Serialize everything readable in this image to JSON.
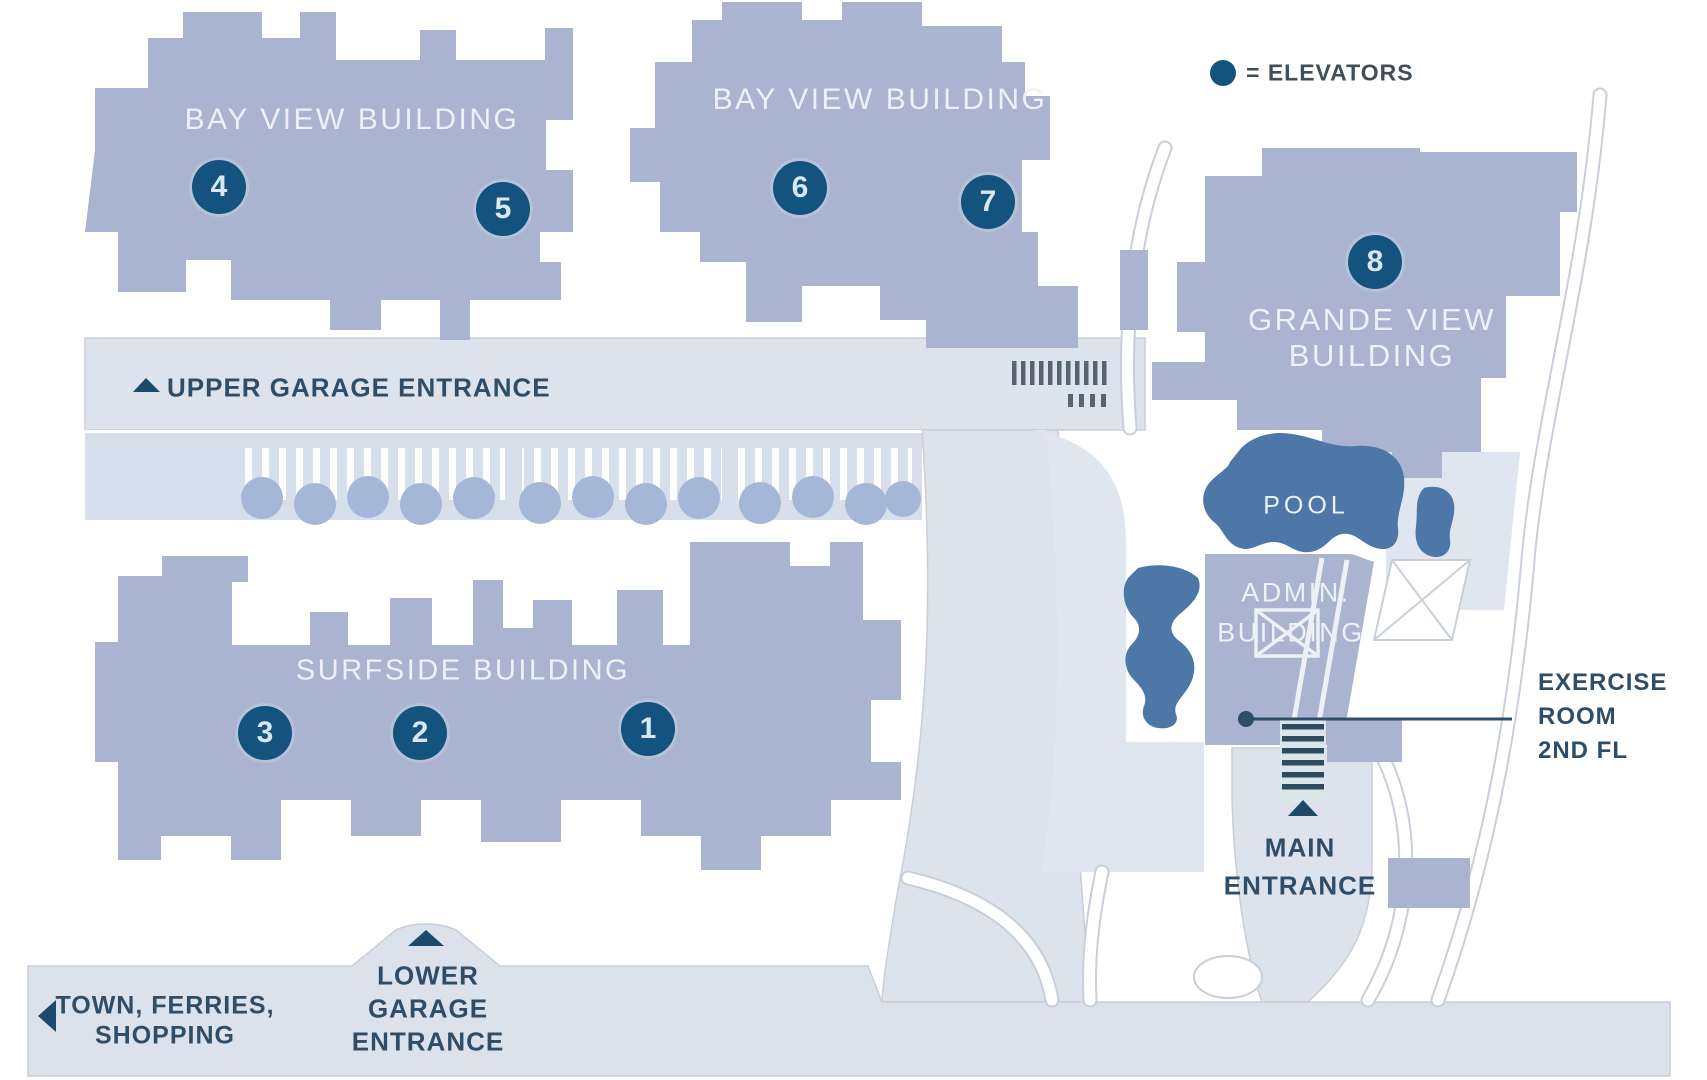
{
  "map": {
    "legend": {
      "symbol": "elevator-dot",
      "label": "= ELEVATORS"
    },
    "buildings": {
      "bay_view_west": {
        "label": "BAY VIEW BUILDING"
      },
      "bay_view_east": {
        "label": "BAY VIEW BUILDING"
      },
      "grande_view": {
        "label_line1": "GRANDE VIEW",
        "label_line2": "BUILDING"
      },
      "surfside": {
        "label": "SURFSIDE BUILDING"
      },
      "admin": {
        "label_line1": "ADMIN.",
        "label_line2": "BUILDING"
      },
      "pool": {
        "label": "POOL"
      }
    },
    "elevator_markers": [
      {
        "number": "4"
      },
      {
        "number": "5"
      },
      {
        "number": "6"
      },
      {
        "number": "7"
      },
      {
        "number": "8"
      },
      {
        "number": "3"
      },
      {
        "number": "2"
      },
      {
        "number": "1"
      }
    ],
    "annotations": {
      "upper_garage": "UPPER GARAGE ENTRANCE",
      "lower_garage": [
        "LOWER",
        "GARAGE",
        "ENTRANCE"
      ],
      "main_entrance": [
        "MAIN",
        "ENTRANCE"
      ],
      "town": [
        "TOWN, FERRIES,",
        "SHOPPING"
      ],
      "exercise_room": [
        "EXERCISE",
        "ROOM",
        "2ND FL"
      ]
    },
    "colors": {
      "building": "#aab4d0",
      "water": "#4d77a7",
      "elevator_marker": "#14537e",
      "road": "#dde3ed",
      "label_dark": "#2e4d68",
      "label_light": "#edf0f6"
    }
  }
}
